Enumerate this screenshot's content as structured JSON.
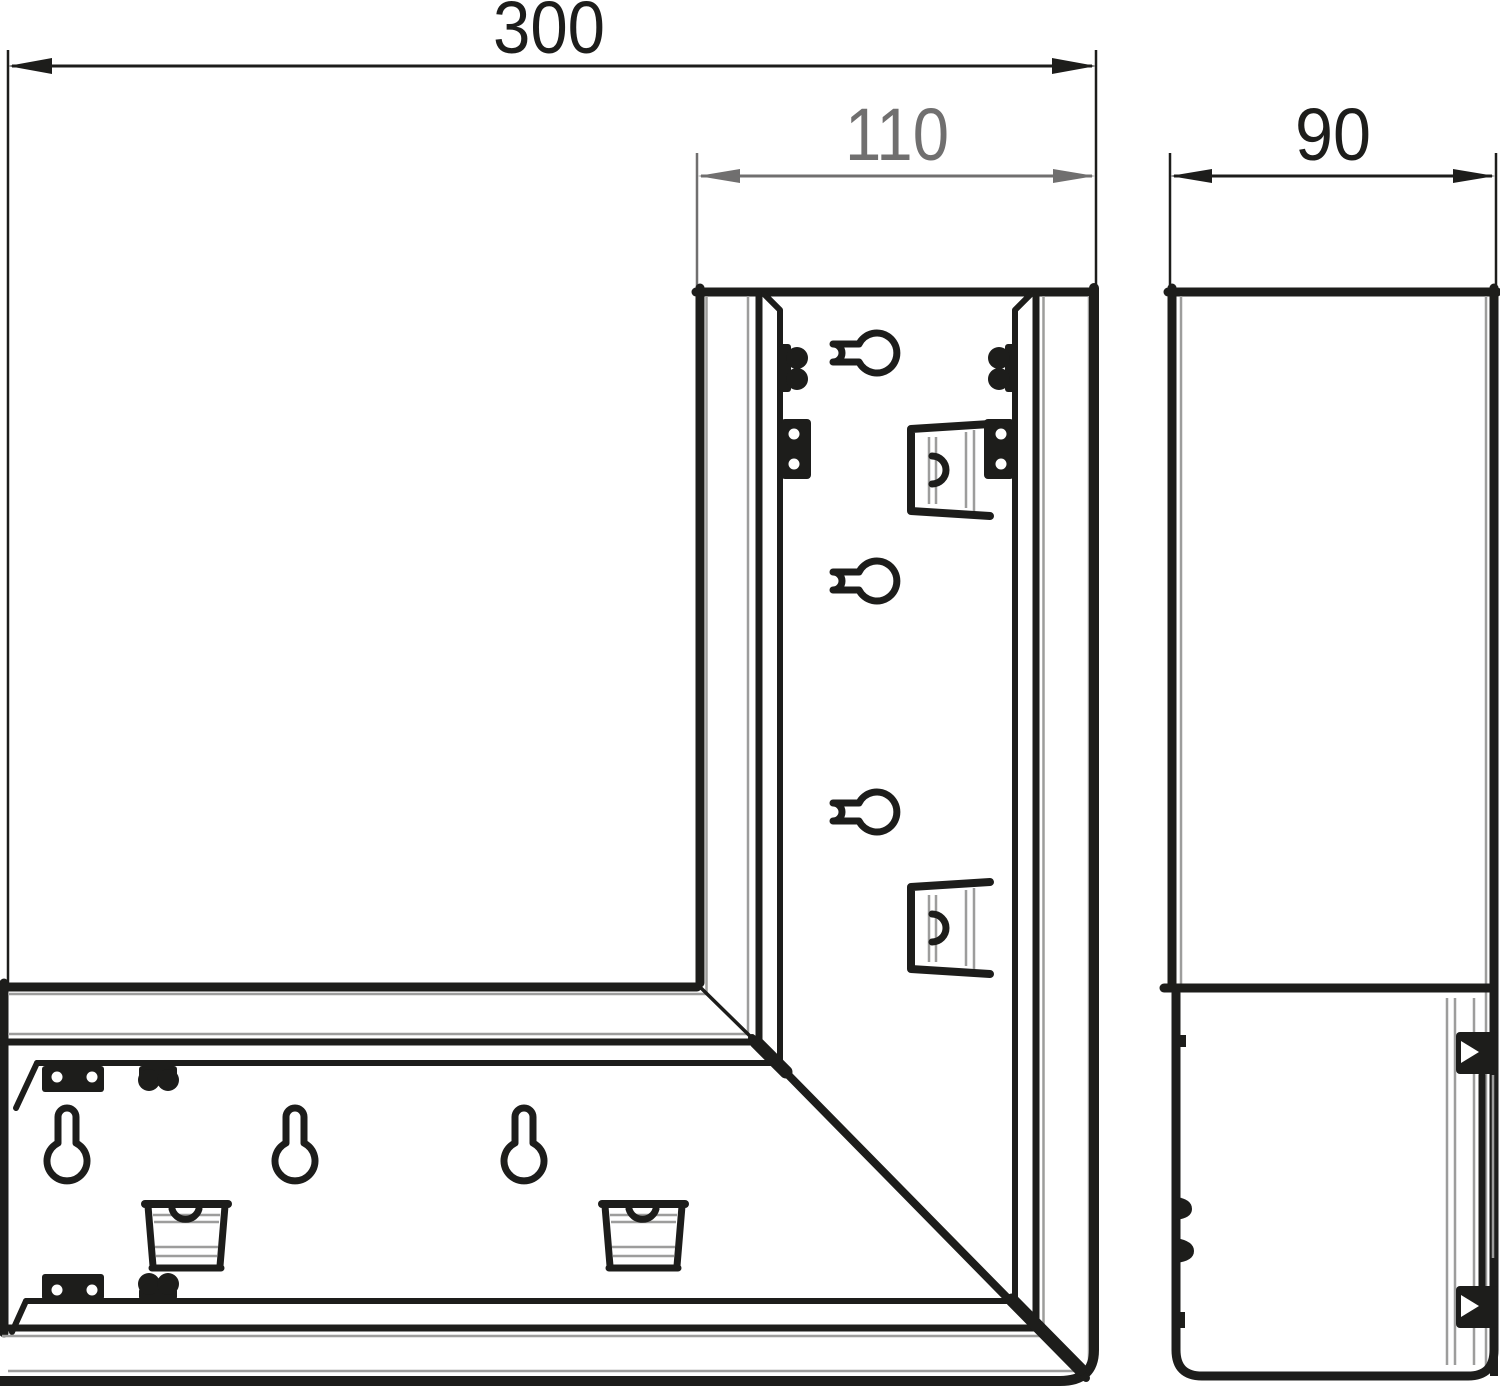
{
  "drawing": {
    "dim_overall_width": "300",
    "dim_duct_width": "110",
    "dim_depth": "90"
  },
  "colors": {
    "line_black": "#1d1d1b",
    "line_gray": "#9d9d9c",
    "dim_gray": "#706f6f",
    "background": "#ffffff"
  }
}
